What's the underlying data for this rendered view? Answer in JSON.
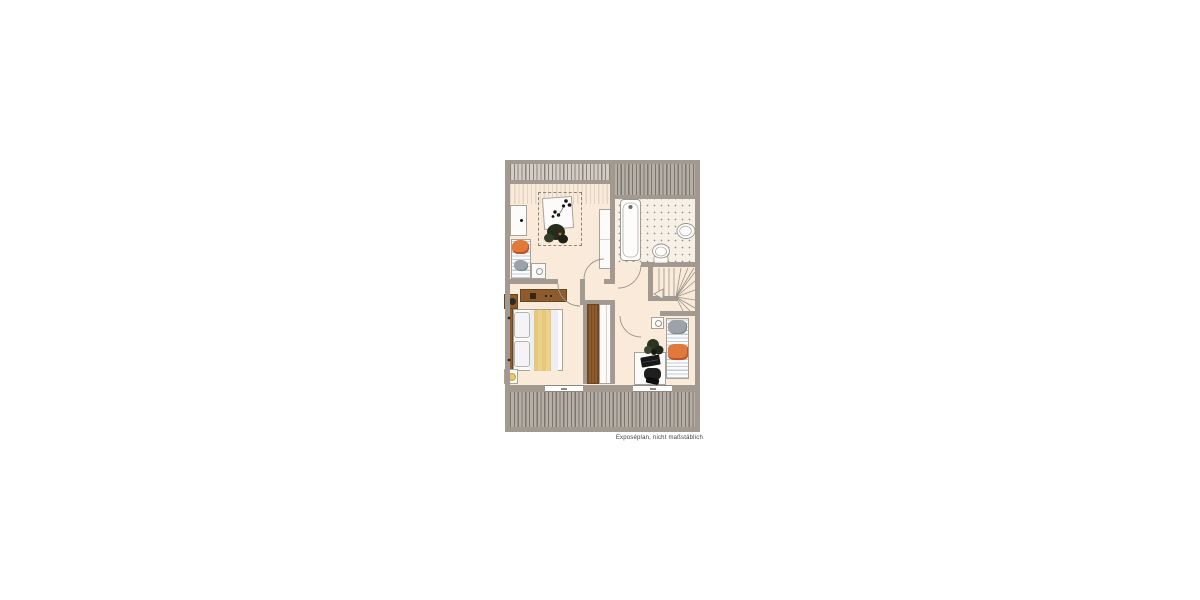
{
  "document": {
    "type": "floor-plan",
    "caption": "Exposéplan, nicht maßstäblich"
  },
  "palette": {
    "wall": "#a29a91",
    "floor": "#f9ead9",
    "tileFloor": "#f7f0e6",
    "hatchBg": "#b6afa6",
    "hatchLine": "#7d766e",
    "hatchLightBg": "#d3cdc6",
    "hatchLightLine": "#8a837b",
    "roomHatchLine": "#e2d5c5",
    "wood": "#8d5c2e",
    "woodDark": "#6c4420",
    "accentOrange": "#df7a3c",
    "blanketYellow": "#e5c87c",
    "furnitureWhite": "#fcfbf9",
    "lineGray": "#9a938b",
    "stripeBlue": "#c3ccd3",
    "plantDark": "#2c3522",
    "captionColor": "#40403e"
  },
  "rooms": [
    {
      "id": "room-upper-left",
      "depicted": [
        "cabinet",
        "table-with-flowers",
        "dashed-roof-zone",
        "lounger",
        "orange-cushion",
        "side-table",
        "wardrobe"
      ]
    },
    {
      "id": "bathroom",
      "depicted": [
        "tiled-floor",
        "bathtub",
        "washbasin",
        "toilet"
      ]
    },
    {
      "id": "staircase",
      "depicted": [
        "winder-stairs",
        "direction-arrow"
      ]
    },
    {
      "id": "hallway",
      "depicted": [
        "built-in-wardrobe",
        "door-swings"
      ]
    },
    {
      "id": "bedroom",
      "depicted": [
        "double-bed",
        "pillows",
        "yellow-duvet",
        "headboard",
        "sideboard",
        "nightstand",
        "lamp-table"
      ]
    },
    {
      "id": "room-lower-right",
      "depicted": [
        "desk",
        "laptop",
        "office-chair",
        "plant",
        "daybed",
        "gray-pillow",
        "orange-cushion",
        "stool"
      ]
    }
  ]
}
